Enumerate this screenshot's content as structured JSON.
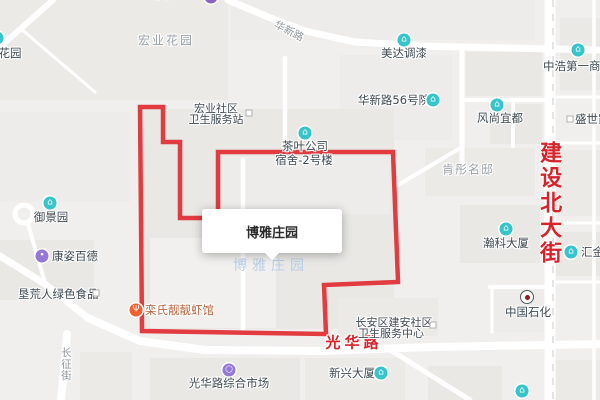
{
  "map": {
    "popup_title": "博雅庄园",
    "watermark": "博雅庄园",
    "road_labels": {
      "jianshe_north_street": "建设北大街",
      "guanghua_road": "光华路",
      "huaxin_road": "华新路",
      "changzheng_street": "长征街"
    },
    "area_labels": {
      "hongye_huayuan": "宏业花园",
      "huayuan_partial": "花园",
      "kentong_mingdi": "肯彤名邸",
      "top_edge_partial": "小微企业",
      "shengshi_partial": "盛世家"
    },
    "poi_labels": {
      "meida_paint": "美达调漆",
      "zhonghao_mall": "中浩第一商城",
      "huaxin_56": "华新路56号院",
      "fengshang_yidu": "风尚宜都",
      "hongye_clinic_line1": "宏业社区",
      "hongye_clinic_line2": "卫生服务站",
      "tea_company_line1": "茶叶公司",
      "tea_company_line2": "宿舍-2号楼",
      "yujing_garden": "御景园",
      "kangzi_baide": "康姿百德",
      "kenhuangren": "垦荒人绿色食品",
      "luanshi_restaurant": "栾氏靓靓虾馆",
      "jianan_clinic_line1": "长安区建安社区",
      "jianan_clinic_line2": "卫生服务中心",
      "xinxing_tower": "新兴大厦",
      "sinopec": "中国石化",
      "huijin": "汇金大厦",
      "hanke_tower": "瀚科大厦",
      "guanghua_market": "光华路综合市场"
    },
    "glyphs": {
      "building": "⌂",
      "restaurant": "Ψ",
      "brand": "•",
      "market_ring": "○"
    },
    "colors": {
      "boundary_red": "#e23b40",
      "road_label_red": "#d7232a",
      "poi_teal": "#35c4ca",
      "poi_purple": "#9678d8",
      "poi_orange": "#f2602f",
      "watermark_blue": "#b9cfe9",
      "road_white": "#ffffff",
      "map_bg": "#f0efed"
    }
  }
}
